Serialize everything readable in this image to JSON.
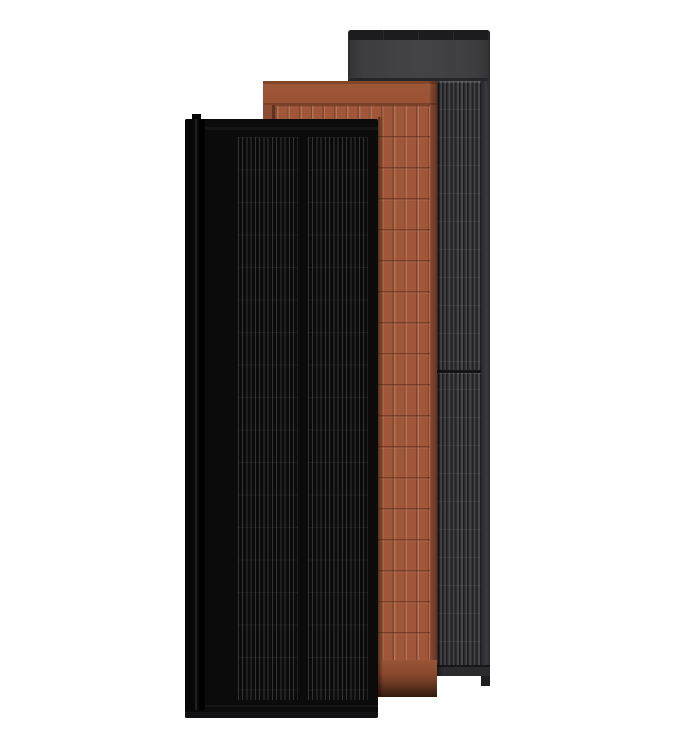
{
  "scene": {
    "title": "Three overlapping solar roof panels",
    "background_color": "#ffffff",
    "panels": [
      {
        "id": "charcoal-gray",
        "name": "Charcoal gray solar panel (back)",
        "frame_color": "#2e2e31",
        "top_strip_color": "#1c1c1e",
        "header_color": "#3e3e41",
        "body_color": "#202023",
        "stripe_color": "#46464a",
        "bottom_color": "#2b2b2e"
      },
      {
        "id": "terracotta",
        "name": "Terracotta solar panel (middle)",
        "lip_color": "#824628",
        "header_color": "#9d5636",
        "body_color": "#9f5639",
        "separator_color": "#7c4229",
        "bottom_shadow_color": "#331a0e"
      },
      {
        "id": "matte-black",
        "name": "Matte black solar panel (front)",
        "body_color": "#0b0b0c",
        "stripe_color": "#2d2d30",
        "bottom_color": "#121214"
      }
    ]
  }
}
